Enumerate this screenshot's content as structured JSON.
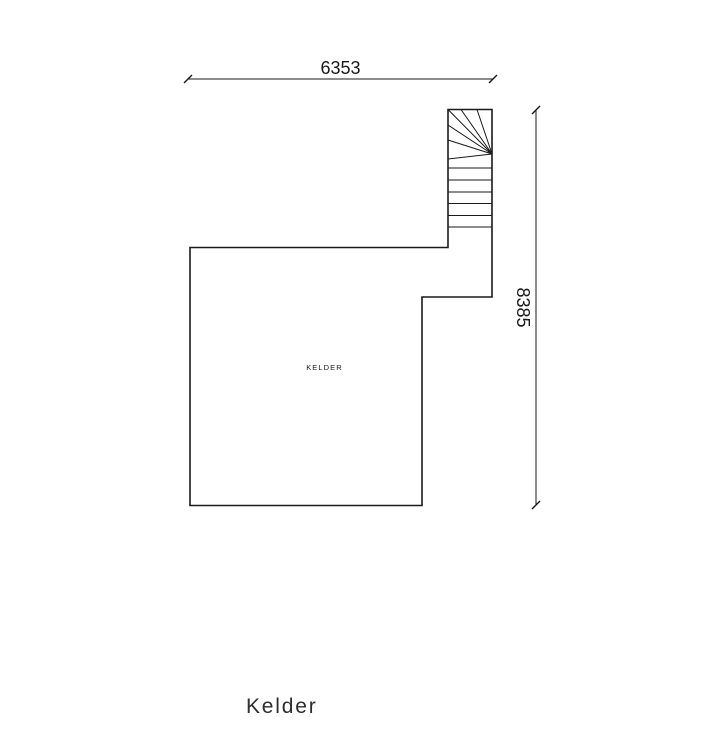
{
  "plan": {
    "room_label": "KELDER",
    "title": "Kelder"
  },
  "dims": {
    "width": "6353",
    "height": "8385"
  },
  "colors": {
    "line": "#1a1a1a",
    "background": "#ffffff",
    "title_text": "#2e2e2e"
  }
}
